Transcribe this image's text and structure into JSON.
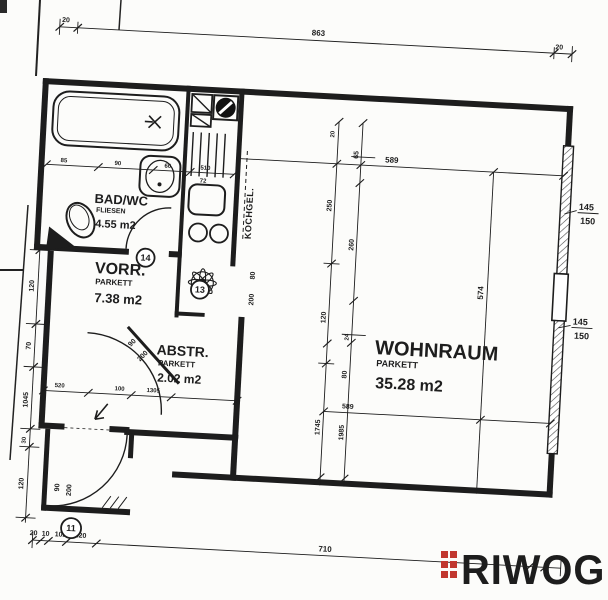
{
  "plan": {
    "rooms": {
      "bad": {
        "name": "BAD/WC",
        "floor": "FLIESEN",
        "area": "4.55 m2"
      },
      "vorraum": {
        "name": "VORR.",
        "floor": "PARKETT",
        "area": "7.38 m2"
      },
      "abstellraum": {
        "name": "ABSTR.",
        "floor": "PARKETT",
        "area": "2.02 m2"
      },
      "wohnraum": {
        "name": "WOHNRAUM",
        "floor": "PARKETT",
        "area": "35.28 m2"
      },
      "kochnische": {
        "name": "KOCHGEL."
      }
    },
    "markers": {
      "m14": "14",
      "m13": "13",
      "m11": "11"
    },
    "dims": {
      "top_left": "20",
      "top_width": "863",
      "top_right": "20",
      "left_1": "120",
      "left_2": "70",
      "left_3": "1045",
      "left_4": "30",
      "left_5": "120",
      "ent_w": "90",
      "ent_h": "200",
      "bath_1": "85",
      "bath_2": "90",
      "bath_3": "60",
      "bath_4": "510",
      "kitchen_72": "72",
      "d13_w": "80",
      "d13_h": "200",
      "vd_w": "90",
      "vd_h": "200",
      "a1": "20",
      "a2": "250",
      "a3": "120",
      "a4": "1745",
      "b1": "65",
      "b2": "260",
      "b3": "24",
      "b4": "80",
      "b5": "1985",
      "wohn_w_top": "589",
      "wohn_w_bottom": "589",
      "wohn_h": "574",
      "win_w": "145",
      "win_h": "150",
      "bottom_1": "20",
      "bottom_2": "10",
      "bottom_3": "102",
      "bottom_4": "320",
      "bottom_5": "710",
      "bottom_6": "20",
      "inner_1": "520",
      "inner_2": "100",
      "inner_3": "1305"
    }
  },
  "logo": {
    "text": "RIWOG"
  },
  "colors": {
    "ink": "#1d1d1d",
    "logo_text": "#47474f",
    "logo_accent": "#c1372f",
    "paper": "#fcfcfa"
  }
}
